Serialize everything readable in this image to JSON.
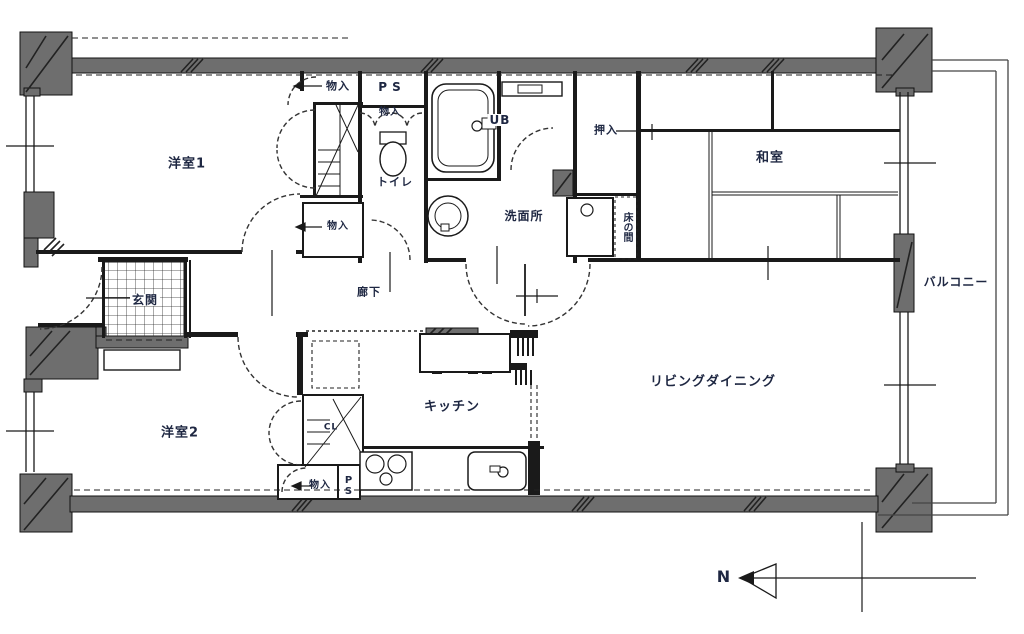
{
  "plan_type": "apartment-floor-plan",
  "colors": {
    "wall": "#6e6e6e",
    "line": "#1a1a1a",
    "label_text": "#1e2742",
    "background": "#ffffff"
  },
  "labels": {
    "yoshitsu1": "洋室1",
    "yoshitsu2": "洋室2",
    "washitsu": "和室",
    "living": "リビングダイニング",
    "kitchen": "キッチン",
    "genkan": "玄関",
    "rouka": "廊下",
    "senmenjo": "洗面所",
    "toilet": "トイレ",
    "ub": "UB",
    "oshiire": "押入",
    "tokonoma": "床の間",
    "balcony": "バルコニー",
    "storage_top": "物入",
    "storage_upper_small": "物入",
    "storage_mid": "物入",
    "storage_bottom": "物入",
    "ps_top": "PS",
    "ps_bottom": "PS",
    "closet_cl": "CL",
    "north": "N"
  }
}
